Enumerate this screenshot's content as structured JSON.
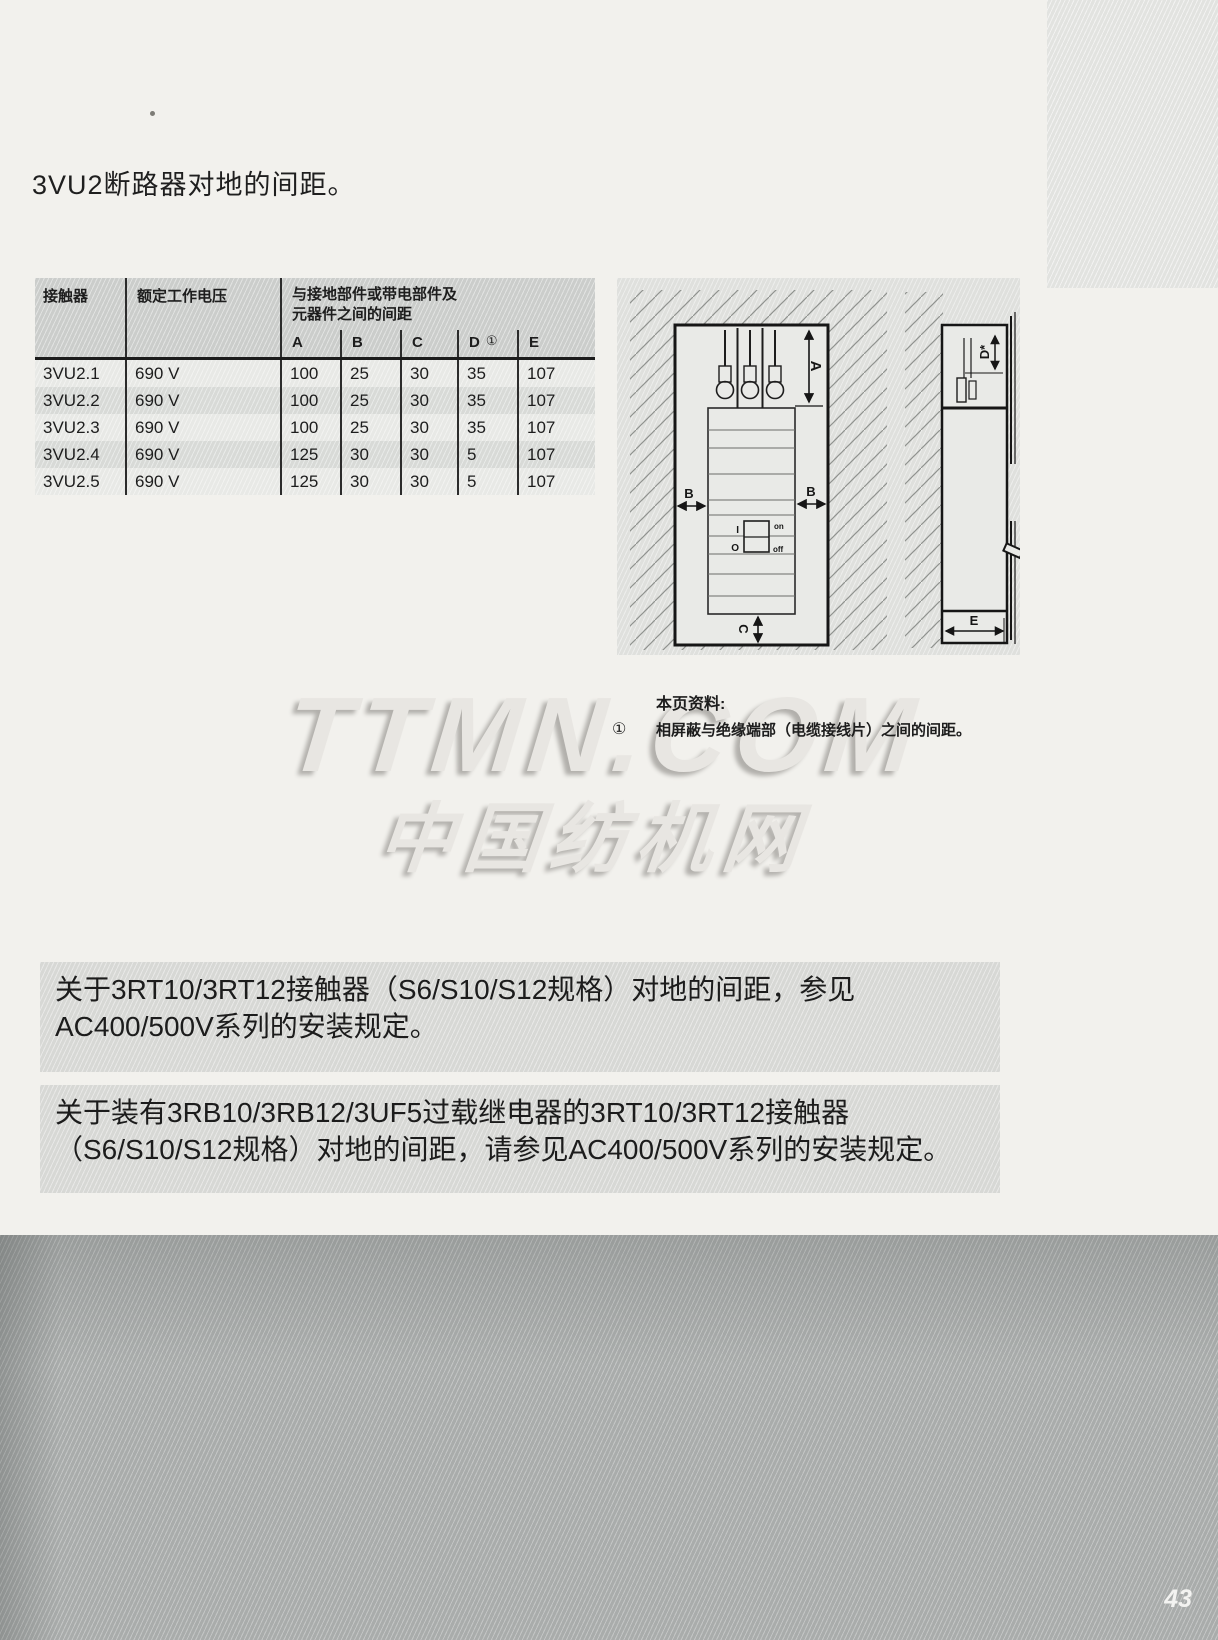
{
  "page": {
    "title": "3VU2断路器对地的间距。",
    "page_number": "43"
  },
  "table": {
    "col_contactor": "接触器",
    "col_voltage": "额定工作电压",
    "group_line1": "与接地部件或带电部件及",
    "group_line2": "元器件之间的间距",
    "dim_headers": [
      "A",
      "B",
      "C",
      "D",
      "E"
    ],
    "d_mark": "①",
    "rows": [
      {
        "model": "3VU2.1",
        "voltage": "690 V",
        "a": "100",
        "b": "25",
        "c": "30",
        "d": "35",
        "e": "107"
      },
      {
        "model": "3VU2.2",
        "voltage": "690 V",
        "a": "100",
        "b": "25",
        "c": "30",
        "d": "35",
        "e": "107"
      },
      {
        "model": "3VU2.3",
        "voltage": "690 V",
        "a": "100",
        "b": "25",
        "c": "30",
        "d": "35",
        "e": "107"
      },
      {
        "model": "3VU2.4",
        "voltage": "690 V",
        "a": "125",
        "b": "30",
        "c": "30",
        "d": "5",
        "e": "107"
      },
      {
        "model": "3VU2.5",
        "voltage": "690 V",
        "a": "125",
        "b": "30",
        "c": "30",
        "d": "5",
        "e": "107"
      }
    ]
  },
  "diagram": {
    "front_view": {
      "dim_a": "A",
      "dim_b_left": "B",
      "dim_b_right": "B",
      "dim_c": "C",
      "switch_i": "I",
      "switch_o": "O",
      "switch_on": "on",
      "switch_off": "off"
    },
    "side_view": {
      "dim_d": "D*",
      "dim_e": "E"
    }
  },
  "note": {
    "heading": "本页资料:",
    "marker": "①",
    "text": "相屏蔽与绝缘端部（电缆接线片）之间的间距。"
  },
  "watermark": {
    "line1": "TTMN.COM",
    "line2": "中国纺机网"
  },
  "paragraphs": [
    "关于3RT10/3RT12接触器（S6/S10/S12规格）对地的间距，参见AC400/500V系列的安装规定。",
    "关于装有3RB10/3RB12/3UF5过载继电器的3RT10/3RT12接触器（S6/S10/S12规格）对地的间距，请参见AC400/500V系列的安装规定。"
  ],
  "colors": {
    "page_bg": "#f2f1ed",
    "panel_gray": "#dfe0dd",
    "table_header_gray": "#cbcdcb",
    "row_light": "#e8e9e6",
    "row_dark": "#d8dad7",
    "block_gray": "#d7d8d5",
    "footer_gray": "#a9acab",
    "ink": "#1c1c1c",
    "watermark_gray": "#e8e6e2"
  }
}
